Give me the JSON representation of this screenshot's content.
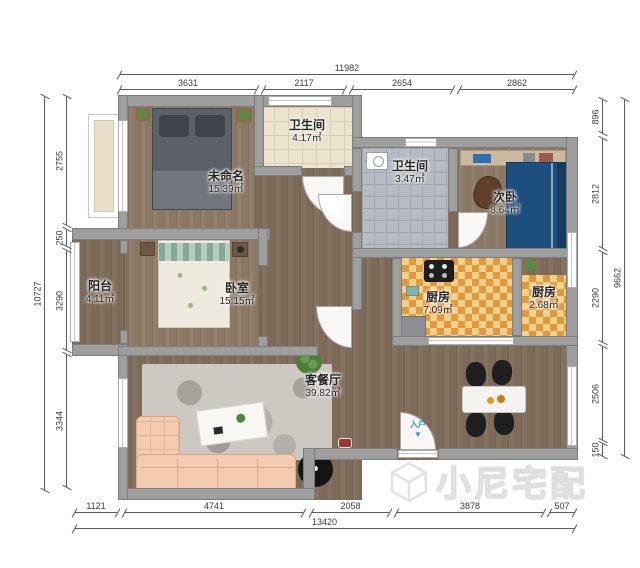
{
  "rooms": [
    {
      "id": "unnamed-bedroom",
      "name": "未命名",
      "area": "15.39㎡"
    },
    {
      "id": "bathroom-1",
      "name": "卫生间",
      "area": "4.17㎡"
    },
    {
      "id": "bathroom-2",
      "name": "卫生间",
      "area": "3.47㎡"
    },
    {
      "id": "second-bedroom",
      "name": "次卧",
      "area": "8.64㎡"
    },
    {
      "id": "kitchen-large",
      "name": "厨房",
      "area": "7.09㎡"
    },
    {
      "id": "kitchen-small",
      "name": "厨房",
      "area": "2.68㎡"
    },
    {
      "id": "balcony",
      "name": "阳台",
      "area": "4.11㎡"
    },
    {
      "id": "master-bedroom",
      "name": "卧室",
      "area": "15.15㎡"
    },
    {
      "id": "living-dining",
      "name": "客餐厅",
      "area": "39.82㎡"
    }
  ],
  "dimensions": {
    "top": {
      "total": "11982",
      "segments": [
        "3631",
        "2117",
        "2654",
        "2862"
      ]
    },
    "bottom": {
      "total": "13420",
      "segments": [
        "1121",
        "4741",
        "2058",
        "3878",
        "507"
      ]
    },
    "left": {
      "total": "10727",
      "segments": [
        "2755",
        "250",
        "3290",
        "3344"
      ]
    },
    "right": {
      "total": "9662",
      "segments": [
        "896",
        "2812",
        "2290",
        "2506",
        "150"
      ]
    }
  },
  "entry": {
    "label": "入户",
    "arrow": "▼"
  },
  "watermark": {
    "text": "小尼宅配",
    "icon": "cube-logo-icon"
  }
}
